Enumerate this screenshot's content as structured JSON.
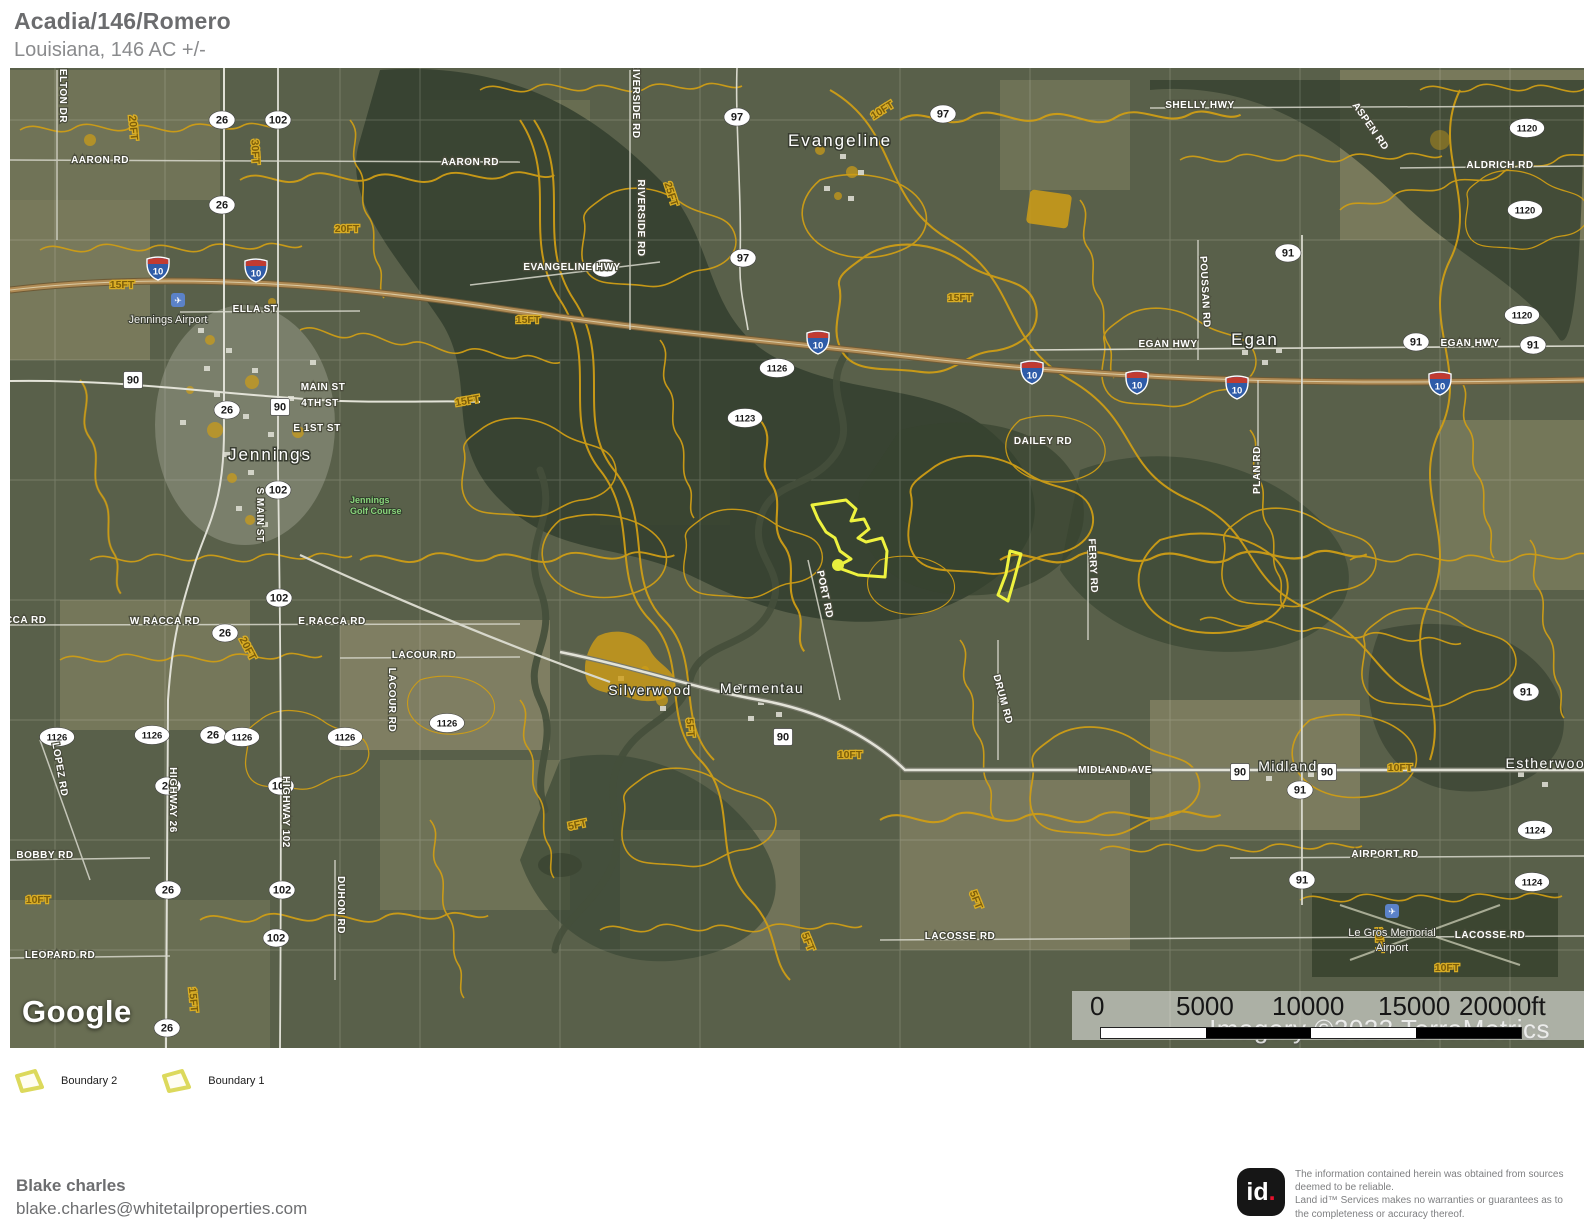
{
  "header": {
    "title": "Acadia/146/Romero",
    "subtitle": "Louisiana, 146 AC +/-"
  },
  "legend": {
    "items": [
      {
        "label": "Boundary 2"
      },
      {
        "label": "Boundary 1"
      }
    ]
  },
  "map": {
    "google_logo": "Google",
    "imagery_credit": "Imagery ©2023 TerraMetrics",
    "scale_ticks": [
      "0",
      "5000",
      "10000",
      "15000",
      "20000ft"
    ],
    "cities": {
      "jennings": "Jennings",
      "evangeline": "Evangeline",
      "egan": "Egan",
      "silverwood": "Silverwood",
      "mermentau": "Mermentau",
      "midland": "Midland",
      "estherwood": "Estherwood"
    },
    "pois": {
      "jennings_airport": "Jennings Airport",
      "golf_line1": "Jennings",
      "golf_line2": "Golf Course",
      "legros_line1": "Le Gros Memorial",
      "legros_line2": "Airport"
    },
    "roads": {
      "elton_dr": "ELTON DR",
      "aaron_rd": "AARON RD",
      "shelly_hwy": "SHELLY HWY",
      "aspen_rd": "ASPEN RD",
      "aldrich_rd": "ALDRICH RD",
      "riverside_rd": "RIVERSIDE RD",
      "evangeline_hwy": "EVANGELINE HWY",
      "ella_st": "ELLA ST",
      "main_st": "MAIN ST",
      "fourth_st": "4TH ST",
      "e_1st_st": "E 1ST ST",
      "s_main_st": "S MAIN ST",
      "egan_hwy": "EGAN HWY",
      "poussan_rd": "POUSSAN RD",
      "plan_rd": "PLAN RD",
      "dailey_rd": "DAILEY RD",
      "w_racca_rd": "W RACCA RD",
      "e_racca_rd": "E RACCA RD",
      "racca_rd": "RACCA RD",
      "lacour_rd": "LACOUR RD",
      "lopez_rd": "LOPEZ RD",
      "highway_26": "HIGHWAY 26",
      "highway_102": "HIGHWAY 102",
      "bobby_rd": "BOBBY RD",
      "duhon_rd": "DUHON RD",
      "leopard_rd": "LEOPARD RD",
      "port_rd": "PORT RD",
      "ferry_rd": "FERRY RD",
      "drum_rd": "DRUM RD",
      "midland_ave": "MIDLAND AVE",
      "airport_rd": "AIRPORT RD",
      "lacosse_rd": "LACOSSE RD"
    },
    "contours": {
      "ft5": "5FT",
      "ft10": "10FT",
      "ft15": "15FT",
      "ft20": "20FT",
      "ft25": "25FT",
      "ft30": "30FT"
    },
    "shields": {
      "i10": "10",
      "us90": "90",
      "la26": "26",
      "la91": "91",
      "la97": "97",
      "la102": "102",
      "la1120": "1120",
      "la1123": "1123",
      "la1124": "1124",
      "la1126": "1126"
    }
  },
  "footer": {
    "name": "Blake charles",
    "email": "blake.charles@whitetailproperties.com"
  },
  "disclaimer": {
    "logo_id": "id",
    "logo_dot": ".",
    "line1": "The information contained herein was obtained from sources deemed to be reliable.",
    "line2": " Land id™ Services makes no warranties or guarantees as to the completeness or accuracy thereof."
  }
}
